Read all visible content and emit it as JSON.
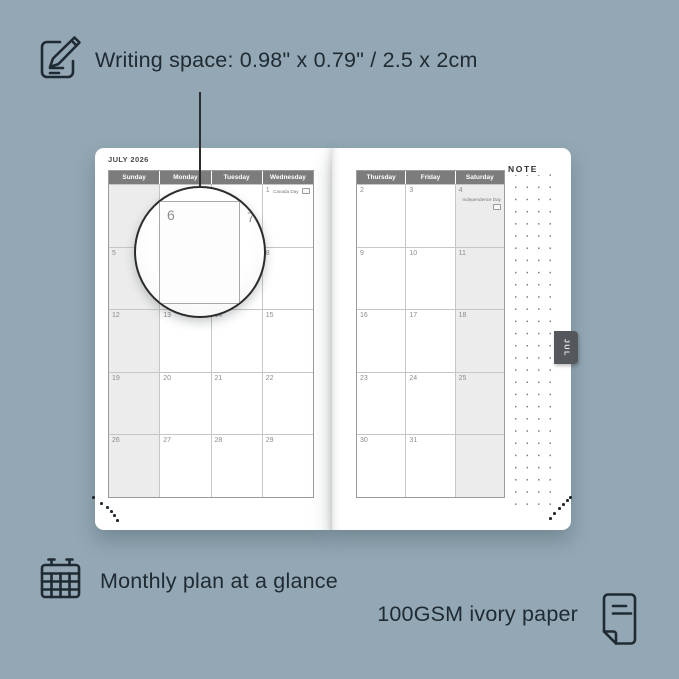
{
  "annotations": {
    "writing_space_label": "Writing space: 0.98\" x 0.79\" / 2.5 x 2cm",
    "monthly_plan_label": "Monthly plan at a glance",
    "paper_label": "100GSM ivory paper"
  },
  "planner": {
    "month_title": "JULY 2026",
    "note_label": "NOTE",
    "tab_label": "JUL",
    "magnifier": {
      "primary_date": "6",
      "next_date": "7"
    },
    "left_page": {
      "day_headers": [
        "Sunday",
        "Monday",
        "Tuesday",
        "Wednesday"
      ],
      "shaded_col": 0,
      "weeks": [
        [
          {
            "date": ""
          },
          {
            "date": ""
          },
          {
            "date": ""
          },
          {
            "date": "1",
            "event": "Canada Day"
          }
        ],
        [
          {
            "date": "5"
          },
          {
            "date": "6"
          },
          {
            "date": "7"
          },
          {
            "date": "8"
          }
        ],
        [
          {
            "date": "12"
          },
          {
            "date": "13"
          },
          {
            "date": "14"
          },
          {
            "date": "15"
          }
        ],
        [
          {
            "date": "19"
          },
          {
            "date": "20"
          },
          {
            "date": "21"
          },
          {
            "date": "22"
          }
        ],
        [
          {
            "date": "26"
          },
          {
            "date": "27"
          },
          {
            "date": "28"
          },
          {
            "date": "29"
          }
        ]
      ]
    },
    "right_page": {
      "day_headers": [
        "Thursday",
        "Friday",
        "Saturday"
      ],
      "shaded_col": 2,
      "weeks": [
        [
          {
            "date": "2"
          },
          {
            "date": "3"
          },
          {
            "date": "4",
            "event": "Independence Day"
          }
        ],
        [
          {
            "date": "9"
          },
          {
            "date": "10"
          },
          {
            "date": "11"
          }
        ],
        [
          {
            "date": "16"
          },
          {
            "date": "17"
          },
          {
            "date": "18"
          }
        ],
        [
          {
            "date": "23"
          },
          {
            "date": "24"
          },
          {
            "date": "25"
          }
        ],
        [
          {
            "date": "30"
          },
          {
            "date": "31"
          },
          {
            "date": ""
          }
        ]
      ]
    }
  },
  "colors": {
    "background": "#93a8b4",
    "ink": "#1f2a32",
    "page": "#ffffff",
    "header_bar": "#7c7c7c",
    "weekend_fill": "#ececec",
    "tab_fill": "#54575b"
  }
}
